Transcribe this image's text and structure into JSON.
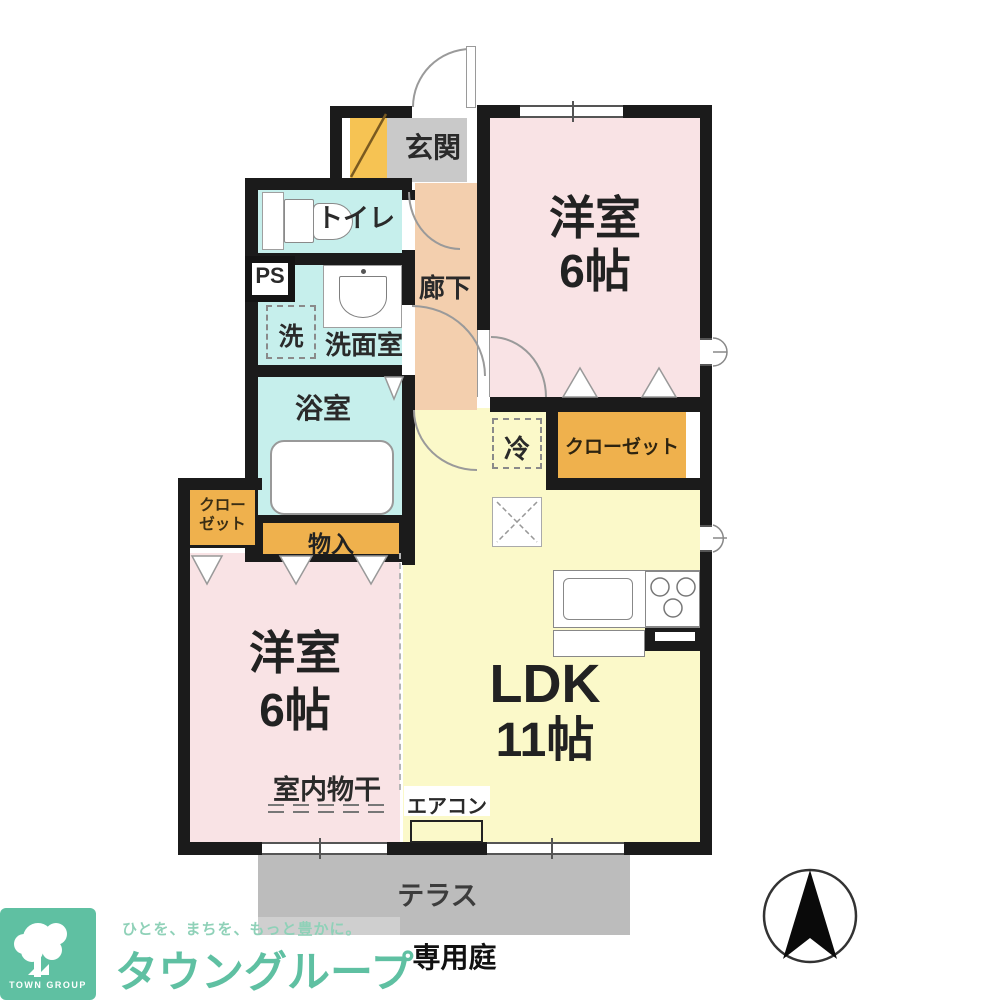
{
  "plan": {
    "rooms": {
      "genkan": "玄関",
      "toilet": "トイレ",
      "ps": "PS",
      "washer": "洗",
      "washroom": "洗面室",
      "corridor": "廊下",
      "bath": "浴室",
      "storage": "物入",
      "closet_left_line1": "クロー",
      "closet_left_line2": "ゼット",
      "closet_right": "クローゼット",
      "fridge": "冷",
      "room_tr_name": "洋室",
      "room_tr_size": "6帖",
      "ldk_name": "LDK",
      "ldk_size": "11帖",
      "room_bl_name": "洋室",
      "room_bl_size": "6帖",
      "indoor_drying": "室内物干",
      "aircon": "エアコン"
    },
    "outdoor": {
      "terrace": "テラス",
      "garden": "専用庭"
    }
  },
  "footer": {
    "logo_square_text": "TOWN GROUP",
    "logo_tagline": "ひとを、まちを、もっと豊かに。",
    "logo_text": "タウングループ"
  },
  "colors": {
    "wall": "#1b1b1b",
    "room_pink": "#f9e3e5",
    "room_yellow": "#fbf9c9",
    "wet_area_cyan": "#c6efec",
    "corridor_peach": "#f3cfae",
    "genkan_gray": "#c9c9c9",
    "closet_orange": "#efb14d",
    "shoe_cabinet_orange": "#f6c353",
    "terrace_gray": "#bcbcbc",
    "brand_green": "#5fc0a2"
  }
}
